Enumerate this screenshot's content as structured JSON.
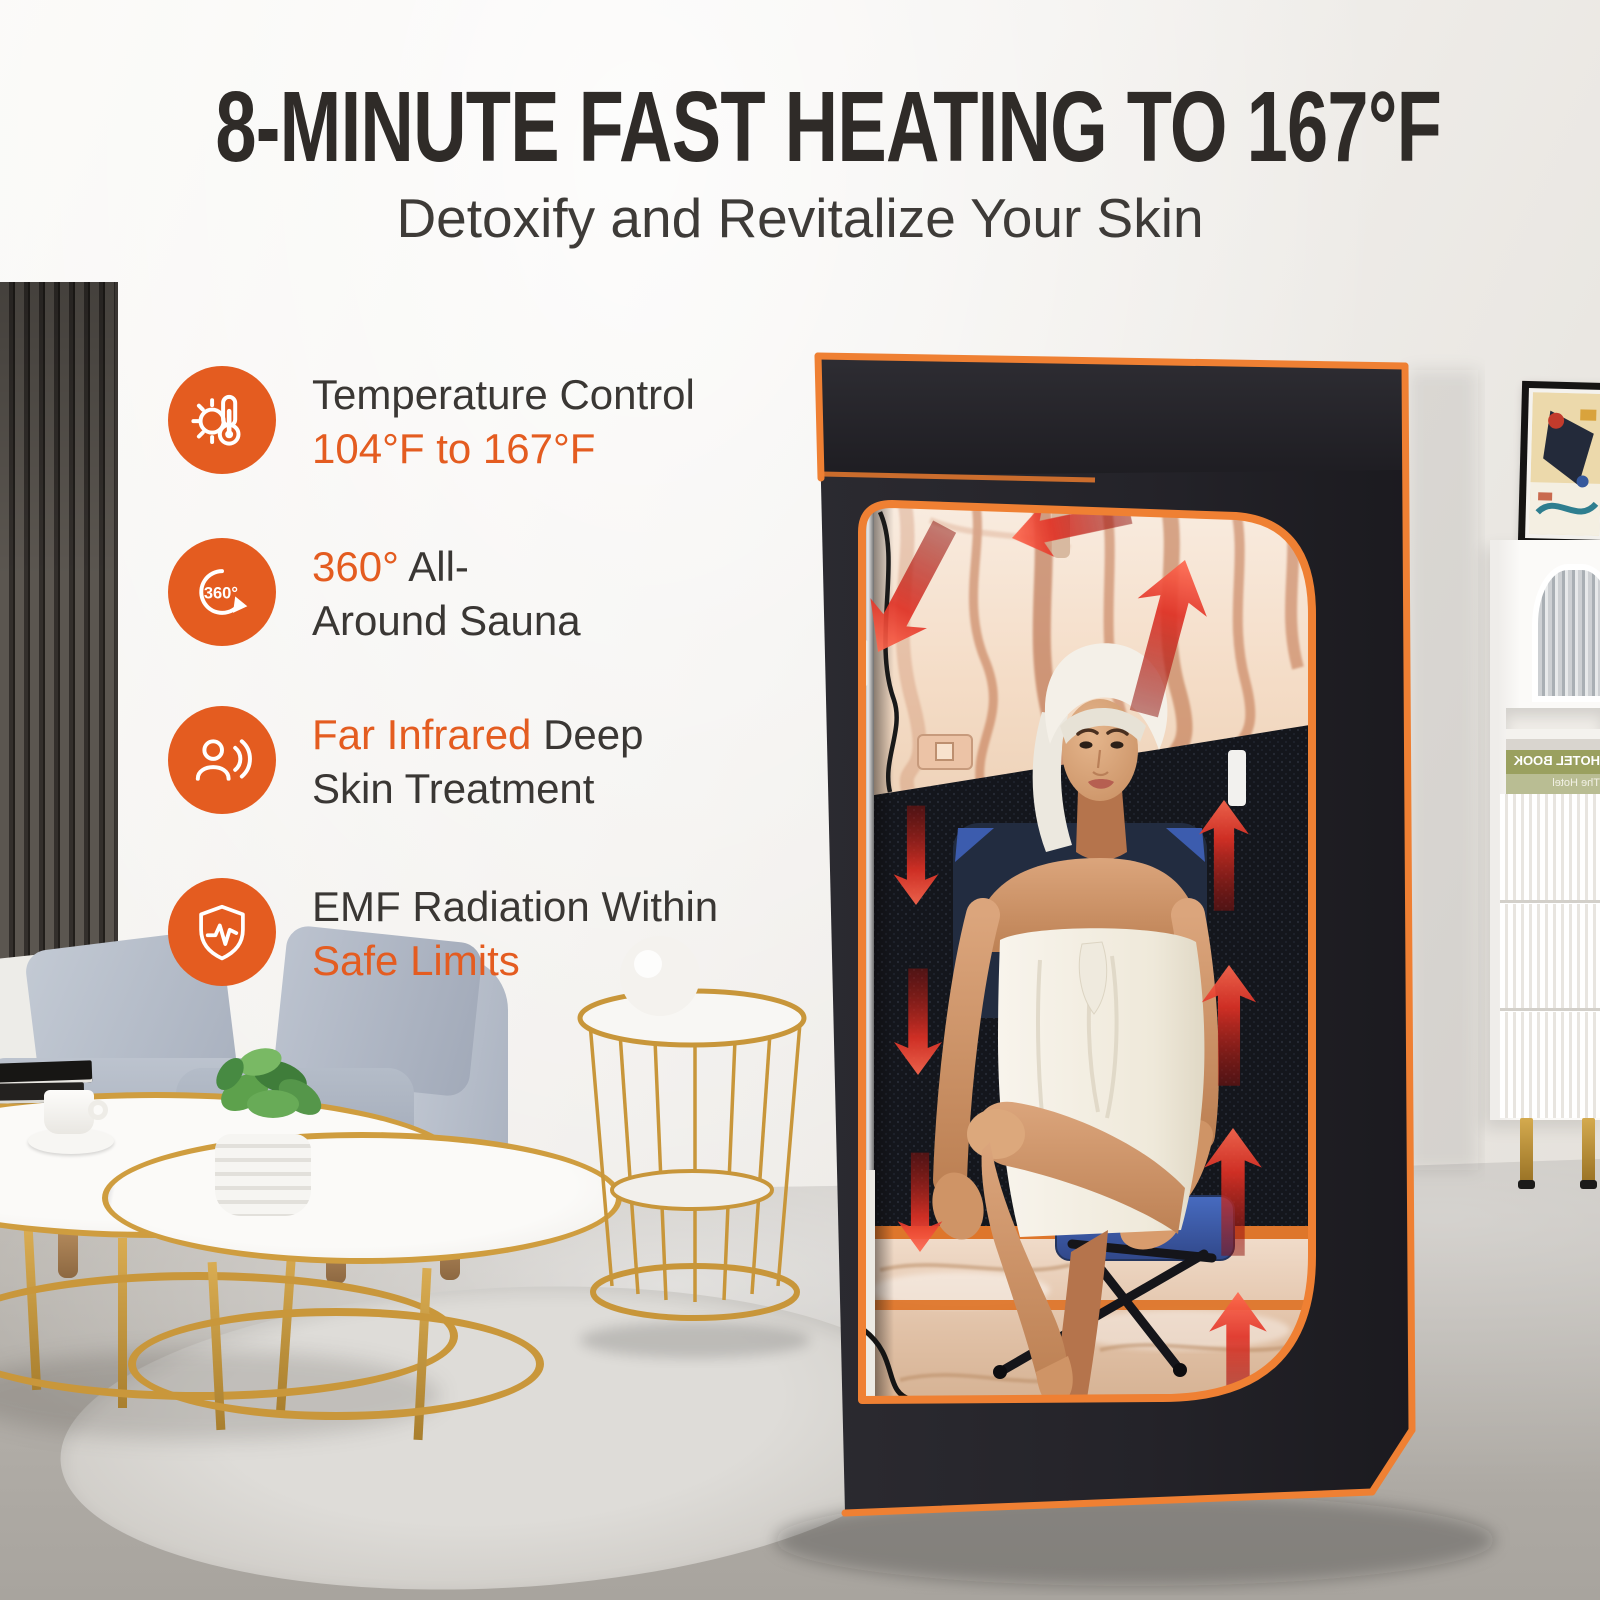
{
  "page": {
    "title": "8-MINUTE FAST HEATING TO 167°F",
    "subtitle": "Detoxify and Revitalize Your Skin"
  },
  "features": [
    {
      "id": "temperature-control",
      "icon": "thermometer-sun-icon",
      "segments": [
        {
          "text": "Temperature Control",
          "tone": "dark"
        },
        {
          "text": "104°F to 167°F",
          "tone": "orange"
        }
      ]
    },
    {
      "id": "all-around-sauna",
      "icon": "rotation-360-icon",
      "segments": [
        {
          "text": "360° ",
          "tone": "orange"
        },
        {
          "text": "All-",
          "tone": "dark"
        },
        {
          "text": "Around Sauna",
          "tone": "dark"
        }
      ]
    },
    {
      "id": "far-infrared",
      "icon": "infrared-person-icon",
      "segments": [
        {
          "text": "Far Infrared ",
          "tone": "orange"
        },
        {
          "text": "Deep",
          "tone": "dark"
        },
        {
          "text": "Skin Treatment",
          "tone": "dark"
        }
      ]
    },
    {
      "id": "emf-safe",
      "icon": "shield-pulse-icon",
      "segments": [
        {
          "text": "EMF Radiation Within",
          "tone": "dark"
        },
        {
          "text": "Safe Limits",
          "tone": "orange"
        }
      ]
    }
  ],
  "icon_labels": {
    "rotation_text": "360°"
  },
  "decor": {
    "book_spine_top": "HOTEL BOOK",
    "book_spine_bottom": "The Hotel"
  },
  "colors": {
    "accent_orange": "#e45c20",
    "trim_orange": "#ef8033",
    "arrow_red": "#d2271b",
    "tent_black": "#26252a",
    "foil_copper": "#f4e0ce",
    "mesh_black": "#14161c",
    "chair_blue": "#3d5ca8",
    "gold": "#c9973b",
    "title_color": "#2f2b28"
  }
}
